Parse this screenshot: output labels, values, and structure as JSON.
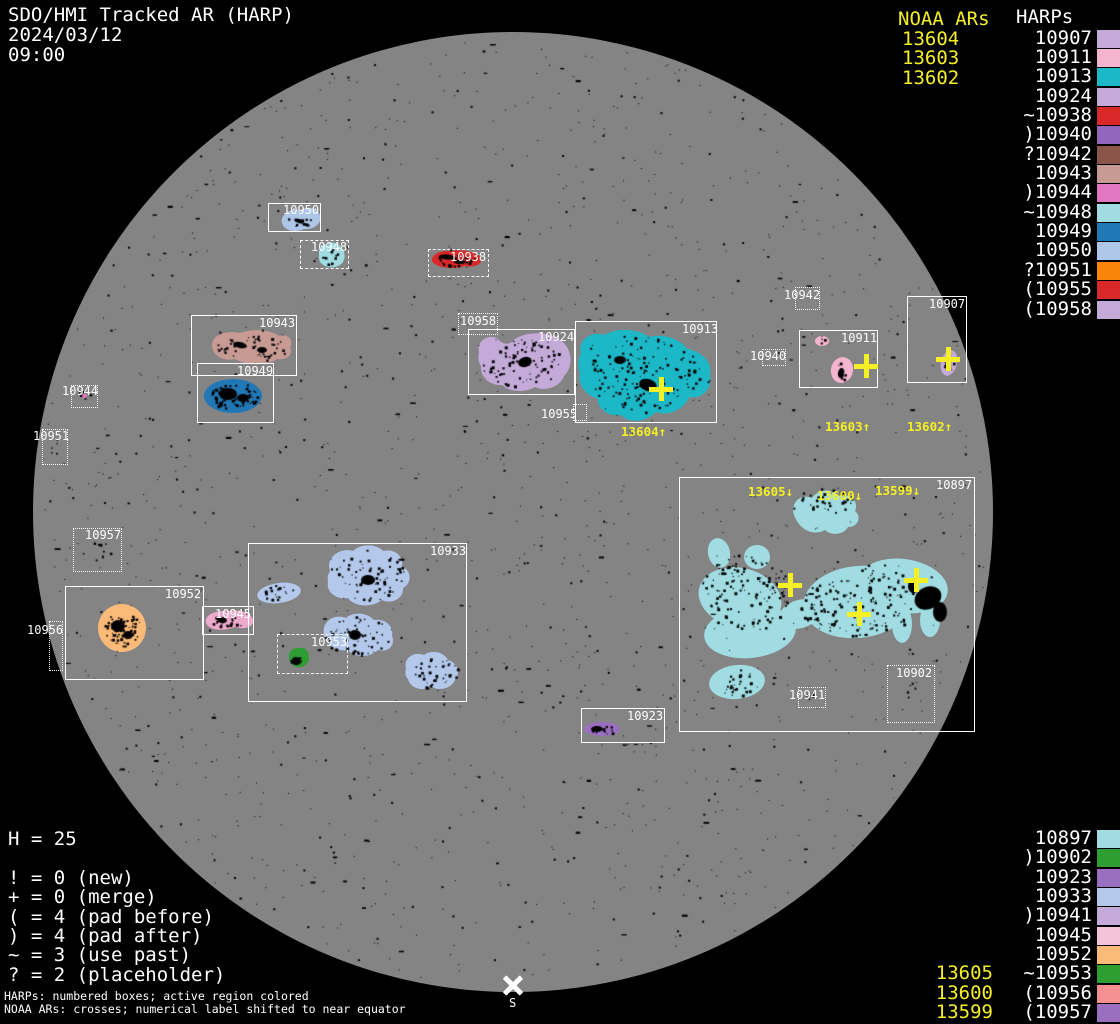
{
  "header": {
    "title": "SDO/HMI Tracked AR (HARP)",
    "date": "2024/03/12",
    "time": "09:00"
  },
  "colors": {
    "background": "#000000",
    "disk": "#848484",
    "box_border": "#ffffff",
    "noaa_yellow": "#f5ef25",
    "label_white": "#ffffff"
  },
  "legend_top": {
    "noaa_title": "NOAA ARs",
    "harp_title": "HARPs",
    "noaa_items": [
      "13604",
      "13603",
      "13602"
    ],
    "harp_items": [
      {
        "label": "10907",
        "color": "#c4aad8"
      },
      {
        "label": "10911",
        "color": "#f5b5cf"
      },
      {
        "label": "10913",
        "color": "#1cb8c8"
      },
      {
        "label": "10924",
        "color": "#c4aad8"
      },
      {
        "label": "~10938",
        "color": "#d82828"
      },
      {
        "label": ")10940",
        "color": "#9166bd"
      },
      {
        "label": "?10942",
        "color": "#8b5549"
      },
      {
        "label": "10943",
        "color": "#c79b93"
      },
      {
        "label": ")10944",
        "color": "#e277c1"
      },
      {
        "label": "~10948",
        "color": "#a0dce2"
      },
      {
        "label": "10949",
        "color": "#2278b5"
      },
      {
        "label": "10950",
        "color": "#aec6e8"
      },
      {
        "label": "?10951",
        "color": "#fb8508"
      },
      {
        "label": "(10955",
        "color": "#d82828"
      },
      {
        "label": "(10958",
        "color": "#c4aad8"
      }
    ]
  },
  "legend_bottom": {
    "harp_items": [
      {
        "noaa": "",
        "label": "10897",
        "color": "#a0dce2"
      },
      {
        "noaa": "",
        "label": ")10902",
        "color": "#2e9d32"
      },
      {
        "noaa": "",
        "label": "10923",
        "color": "#9a6fc0"
      },
      {
        "noaa": "",
        "label": "10933",
        "color": "#b3c8ea"
      },
      {
        "noaa": "",
        "label": ")10941",
        "color": "#c4aad8"
      },
      {
        "noaa": "",
        "label": "10945",
        "color": "#f3c3d9"
      },
      {
        "noaa": "",
        "label": "10952",
        "color": "#fbba78"
      },
      {
        "noaa": "13605",
        "label": "~10953",
        "color": "#2e9d32"
      },
      {
        "noaa": "13600",
        "label": "(10956",
        "color": "#f49090"
      },
      {
        "noaa": "13599",
        "label": "(10957",
        "color": "#9a6fc0"
      }
    ]
  },
  "stats": {
    "h_line": "H = 25",
    "lines": [
      "! = 0 (new)",
      "+ = 0 (merge)",
      "( = 4 (pad before)",
      ") = 4 (pad after)",
      "~ = 3 (use past)",
      "? = 2 (placeholder)"
    ]
  },
  "footer": {
    "line1": "HARPs: numbered boxes; active region colored",
    "line2": "NOAA ARs: crosses; numerical label shifted to near equator"
  },
  "south_marker": {
    "label": "S"
  },
  "chart_data": {
    "type": "scatter",
    "title": "SDO/HMI Tracked AR (HARP)",
    "timestamp": "2024/03/12 09:00",
    "disk": {
      "cx": 513,
      "cy": 512,
      "r": 480
    },
    "harp_count": 25,
    "harp_regions": [
      {
        "harp": "10950",
        "box": [
          268,
          203,
          53,
          29
        ],
        "border": "solid",
        "label_pos": [
          283,
          204
        ],
        "color": "#aec6e8"
      },
      {
        "harp": "10948",
        "box": [
          300,
          240,
          49,
          29
        ],
        "border": "dashed",
        "label_pos": [
          311,
          241
        ],
        "color": "#a0dce2"
      },
      {
        "harp": "10938",
        "box": [
          428,
          249,
          61,
          28
        ],
        "border": "dashed",
        "label_pos": [
          450,
          251
        ],
        "color": "#d82828"
      },
      {
        "harp": "10943",
        "box": [
          191,
          315,
          106,
          61
        ],
        "border": "solid",
        "label_pos": [
          259,
          317
        ],
        "color": "#c79b93"
      },
      {
        "harp": "10949",
        "box": [
          197,
          363,
          77,
          60
        ],
        "border": "solid",
        "label_pos": [
          237,
          365
        ],
        "color": "#2278b5"
      },
      {
        "harp": "10944",
        "box": [
          71,
          385,
          27,
          23
        ],
        "border": "dotted",
        "label_pos": [
          62,
          385
        ],
        "color": "#e277c1"
      },
      {
        "harp": "10951",
        "box": [
          42,
          429,
          26,
          36
        ],
        "border": "dotted",
        "label_pos": [
          33,
          430
        ],
        "color": "#fb8508"
      },
      {
        "harp": "10958",
        "box": [
          458,
          313,
          40,
          22
        ],
        "border": "dotted",
        "label_pos": [
          460,
          315
        ],
        "color": "#c4aad8"
      },
      {
        "harp": "10924",
        "box": [
          468,
          329,
          107,
          66
        ],
        "border": "solid",
        "label_pos": [
          538,
          331
        ],
        "color": "#c4aad8"
      },
      {
        "harp": "10913",
        "box": [
          575,
          321,
          142,
          102
        ],
        "border": "solid",
        "label_pos": [
          682,
          323
        ],
        "color": "#1cb8c8"
      },
      {
        "harp": "10955",
        "box": [
          573,
          404,
          14,
          17
        ],
        "border": "dotted",
        "label_pos": [
          541,
          408
        ],
        "color": "#d82828"
      },
      {
        "harp": "10942",
        "box": [
          795,
          287,
          25,
          23
        ],
        "border": "dotted",
        "label_pos": [
          784,
          289
        ],
        "color": "#8b5549"
      },
      {
        "harp": "10940",
        "box": [
          762,
          349,
          24,
          17
        ],
        "border": "dotted",
        "label_pos": [
          750,
          350
        ],
        "color": "#9166bd"
      },
      {
        "harp": "10911",
        "box": [
          799,
          330,
          79,
          58
        ],
        "border": "solid",
        "label_pos": [
          841,
          332
        ],
        "color": "#f5b5cf"
      },
      {
        "harp": "10907",
        "box": [
          907,
          296,
          60,
          87
        ],
        "border": "solid",
        "label_pos": [
          929,
          298
        ],
        "color": "#c4aad8"
      },
      {
        "harp": "10957",
        "box": [
          73,
          528,
          49,
          44
        ],
        "border": "dotted",
        "label_pos": [
          85,
          529
        ],
        "color": "#9a6fc0"
      },
      {
        "harp": "10952",
        "box": [
          65,
          586,
          139,
          94
        ],
        "border": "solid",
        "label_pos": [
          165,
          588
        ],
        "color": "#fbba78"
      },
      {
        "harp": "10945",
        "box": [
          202,
          606,
          52,
          29
        ],
        "border": "solid",
        "label_pos": [
          215,
          608
        ],
        "color": "#eeaacc"
      },
      {
        "harp": "10956",
        "box": [
          49,
          621,
          14,
          50
        ],
        "border": "dotted",
        "label_pos": [
          27,
          624
        ],
        "color": "#f49090"
      },
      {
        "harp": "10933",
        "box": [
          248,
          543,
          219,
          159
        ],
        "border": "solid",
        "label_pos": [
          430,
          545
        ],
        "color": "#b3c8ea"
      },
      {
        "harp": "10953",
        "box": [
          277,
          634,
          71,
          40
        ],
        "border": "dashed",
        "label_pos": [
          311,
          636
        ],
        "color": "#2e9d32"
      },
      {
        "harp": "10923",
        "box": [
          581,
          708,
          84,
          35
        ],
        "border": "solid",
        "label_pos": [
          627,
          710
        ],
        "color": "#9a6fc0"
      },
      {
        "harp": "10897",
        "box": [
          679,
          477,
          296,
          255
        ],
        "border": "solid",
        "label_pos": [
          936,
          479
        ],
        "color": "#a0dce2"
      },
      {
        "harp": "10941",
        "box": [
          798,
          687,
          28,
          21
        ],
        "border": "dotted",
        "label_pos": [
          789,
          689
        ],
        "color": "#c4aad8"
      },
      {
        "harp": "10902",
        "box": [
          887,
          665,
          48,
          58
        ],
        "border": "dotted",
        "label_pos": [
          896,
          667
        ],
        "color": "#2e9d32"
      }
    ],
    "noaa_disk_labels": [
      {
        "text": "13604↑",
        "x": 621,
        "y": 425
      },
      {
        "text": "13603↑",
        "x": 825,
        "y": 420
      },
      {
        "text": "13602↑",
        "x": 907,
        "y": 420
      },
      {
        "text": "13605↓",
        "x": 748,
        "y": 485
      },
      {
        "text": "13600↓",
        "x": 817,
        "y": 489
      },
      {
        "text": "13599↓",
        "x": 875,
        "y": 484
      }
    ],
    "noaa_crosses": [
      {
        "x": 661,
        "y": 389
      },
      {
        "x": 866,
        "y": 366
      },
      {
        "x": 948,
        "y": 359
      },
      {
        "x": 790,
        "y": 585
      },
      {
        "x": 859,
        "y": 614
      },
      {
        "x": 916,
        "y": 580
      }
    ]
  }
}
